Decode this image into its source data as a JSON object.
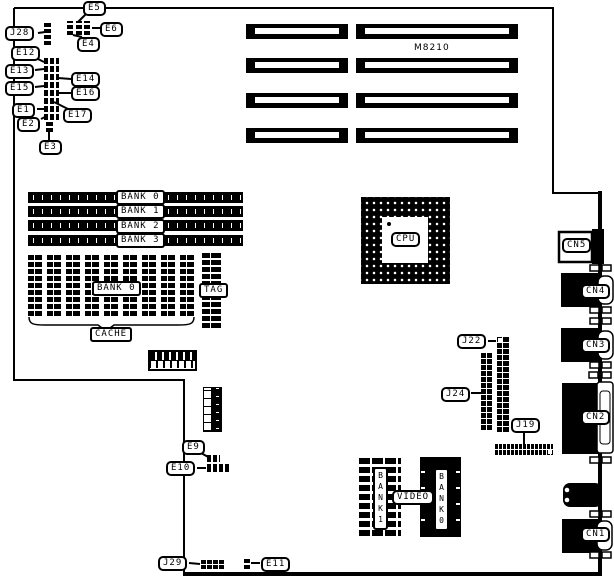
{
  "board": {
    "model": "M8210"
  },
  "jumpers": {
    "j28": "J28",
    "e1": "E1",
    "e2": "E2",
    "e3": "E3",
    "e4": "E4",
    "e5": "E5",
    "e6": "E6",
    "e9": "E9",
    "e10": "E10",
    "e11": "E11",
    "e12": "E12",
    "e13": "E13",
    "e14": "E14",
    "e15": "E15",
    "e16": "E16",
    "e17": "E17"
  },
  "headers": {
    "j19": "J19",
    "j22": "J22",
    "j24": "J24",
    "j29": "J29"
  },
  "memory": {
    "simm_banks": [
      "BANK 0",
      "BANK 1",
      "BANK 2",
      "BANK 3"
    ],
    "cache_bank": "BANK 0",
    "cache_label": "CACHE",
    "tag_label": "TAG"
  },
  "cpu_label": "CPU",
  "video_memory": {
    "video_label": "VIDEO",
    "bank1_label": "BANK1",
    "bank0_label": "BANK0"
  },
  "rear_connectors": {
    "cn1": "CN1",
    "cn2": "CN2",
    "cn3": "CN3",
    "cn4": "CN4",
    "cn5": "CN5"
  }
}
